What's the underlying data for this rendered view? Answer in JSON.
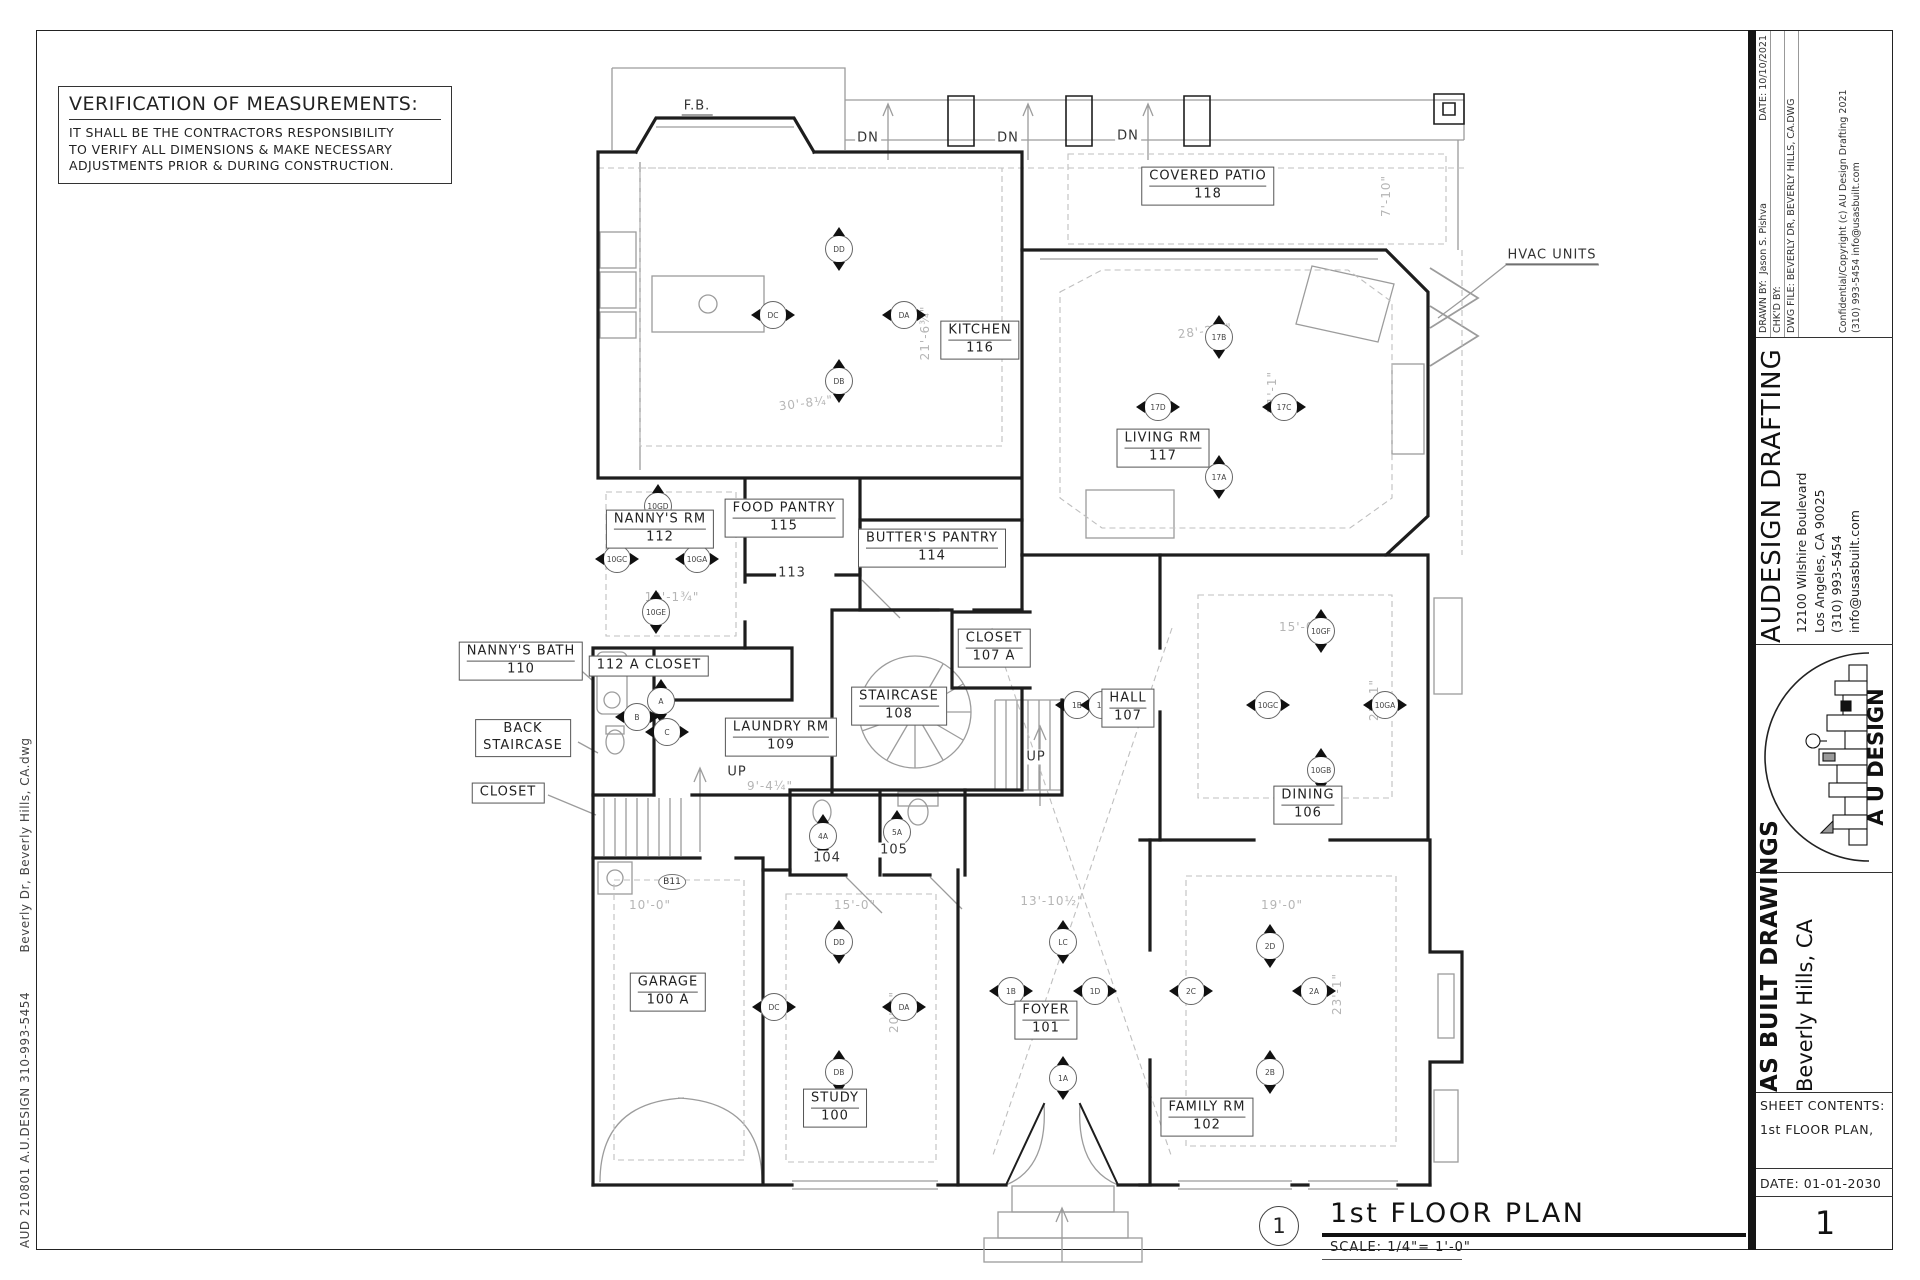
{
  "sheet": {
    "verification": {
      "title": "VERIFICATION OF MEASUREMENTS:",
      "lines": [
        "IT SHALL BE THE CONTRACTORS RESPONSIBILITY",
        "TO VERIFY ALL DIMENSIONS & MAKE NECESSARY",
        "ADJUSTMENTS PRIOR & DURING CONSTRUCTION."
      ]
    },
    "margin_text_top": "Beverly Dr, Beverly Hills, CA.dwg",
    "margin_text_bottom": "AUD 210801    A.U.DESIGN 310-993-5454",
    "plan_title": {
      "detail_number": "1",
      "title": "1st FLOOR PLAN",
      "scale": "SCALE: 1/4\"= 1'-0\""
    }
  },
  "title_block": {
    "drawn_by_label": "DRAWN BY:",
    "drawn_by": "Jason S. Pishva",
    "date_label": "DATE:",
    "date": "10/10/2021",
    "chkd_by_label": "CHK'D BY:",
    "dwg_file": "DWG FILE: BEVERLY DR, BEVERLY HILLS, CA.DWG",
    "copyright": "Confidential/Copyright (c) AU Design Drafting   2021",
    "copyright_contact": "(310) 993-5454    info@usasbuilt.com",
    "company": "AUDESIGN DRAFTING",
    "address_line1": "12100 Wilshire Boulevard",
    "address_line2": "Los Angeles, CA 90025",
    "phone": "(310) 993-5454",
    "email": "info@usasbuilt.com",
    "logo_text": "A U DESIGN",
    "project_title": "AS BUILT DRAWINGS",
    "project_location": "Beverly Hills, CA",
    "sheet_contents_label": "SHEET CONTENTS:",
    "sheet_contents_value": "1st FLOOR PLAN,",
    "date_row": "DATE: 01-01-2030",
    "sheet_number": "1"
  },
  "plan": {
    "rooms": [
      {
        "lines": [
          "KITCHEN",
          "116"
        ],
        "x": 980,
        "y": 340,
        "divider": true
      },
      {
        "lines": [
          "COVERED PATIO",
          "118"
        ],
        "x": 1208,
        "y": 186,
        "divider": true
      },
      {
        "lines": [
          "LIVING RM",
          "117"
        ],
        "x": 1163,
        "y": 448,
        "divider": true
      },
      {
        "lines": [
          "NANNY'S RM",
          "112"
        ],
        "x": 660,
        "y": 529,
        "divider": true
      },
      {
        "lines": [
          "FOOD PANTRY",
          "115"
        ],
        "x": 784,
        "y": 518,
        "divider": true
      },
      {
        "lines": [
          "BUTTER'S PANTRY",
          "114"
        ],
        "x": 932,
        "y": 548,
        "divider": true
      },
      {
        "lines": [
          "CLOSET",
          "107 A"
        ],
        "x": 994,
        "y": 648,
        "divider": true
      },
      {
        "lines": [
          "STAIRCASE",
          "108"
        ],
        "x": 899,
        "y": 706,
        "divider": true
      },
      {
        "lines": [
          "HALL",
          "107"
        ],
        "x": 1128,
        "y": 708,
        "divider": true
      },
      {
        "lines": [
          "NANNY'S BATH",
          "110"
        ],
        "x": 521,
        "y": 661,
        "divider": true
      },
      {
        "lines": [
          "112 A CLOSET"
        ],
        "x": 649,
        "y": 666,
        "divider": false
      },
      {
        "lines": [
          "BACK",
          "STAIRCASE"
        ],
        "x": 523,
        "y": 738,
        "divider": false
      },
      {
        "lines": [
          "LAUNDRY RM",
          "109"
        ],
        "x": 781,
        "y": 737,
        "divider": true
      },
      {
        "lines": [
          "CLOSET"
        ],
        "x": 508,
        "y": 793,
        "divider": false
      },
      {
        "lines": [
          "DINING",
          "106"
        ],
        "x": 1308,
        "y": 805,
        "divider": true
      },
      {
        "lines": [
          "GARAGE",
          "100 A"
        ],
        "x": 668,
        "y": 992,
        "divider": true
      },
      {
        "lines": [
          "STUDY",
          "100"
        ],
        "x": 835,
        "y": 1108,
        "divider": true
      },
      {
        "lines": [
          "FOYER",
          "101"
        ],
        "x": 1046,
        "y": 1020,
        "divider": true
      },
      {
        "lines": [
          "FAMILY RM",
          "102"
        ],
        "x": 1207,
        "y": 1117,
        "divider": true
      }
    ],
    "labels": [
      {
        "text": "F.B.",
        "x": 697,
        "y": 107,
        "style": "underline"
      },
      {
        "text": "DN",
        "x": 868,
        "y": 138,
        "style": "plain"
      },
      {
        "text": "DN",
        "x": 1008,
        "y": 138,
        "style": "plain"
      },
      {
        "text": "DN",
        "x": 1128,
        "y": 136,
        "style": "plain"
      },
      {
        "text": "HVAC UNITS",
        "x": 1552,
        "y": 256,
        "style": "underline"
      },
      {
        "text": "113",
        "x": 792,
        "y": 573,
        "style": "plain"
      },
      {
        "text": "UP",
        "x": 737,
        "y": 772,
        "style": "plain"
      },
      {
        "text": "UP",
        "x": 1036,
        "y": 757,
        "style": "plain"
      },
      {
        "text": "104",
        "x": 827,
        "y": 858,
        "style": "plain"
      },
      {
        "text": "105",
        "x": 894,
        "y": 850,
        "style": "plain"
      },
      {
        "text": "B11",
        "x": 672,
        "y": 882,
        "style": "oval"
      }
    ],
    "dimensions": [
      {
        "text": "21'-6¾\"",
        "x": 925,
        "y": 333,
        "rot": -90
      },
      {
        "text": "30'-8¼\"",
        "x": 806,
        "y": 403,
        "rot": -7
      },
      {
        "text": "28'-2½\"",
        "x": 1205,
        "y": 331,
        "rot": -7
      },
      {
        "text": "21'-1\"",
        "x": 1272,
        "y": 392,
        "rot": -90
      },
      {
        "text": "7'-10\"",
        "x": 1386,
        "y": 196,
        "rot": -90
      },
      {
        "text": "12'-1¾\"",
        "x": 672,
        "y": 597,
        "rot": 0
      },
      {
        "text": "15'-0\"",
        "x": 1300,
        "y": 627,
        "rot": 0
      },
      {
        "text": "21'-1\"",
        "x": 1374,
        "y": 700,
        "rot": -90
      },
      {
        "text": "9'-4¼\"",
        "x": 770,
        "y": 786,
        "rot": 0
      },
      {
        "text": "10'-0\"",
        "x": 650,
        "y": 905,
        "rot": 0
      },
      {
        "text": "15'-0\"",
        "x": 855,
        "y": 905,
        "rot": 0
      },
      {
        "text": "13'-10½\"",
        "x": 1052,
        "y": 901,
        "rot": 0
      },
      {
        "text": "19'-0\"",
        "x": 1282,
        "y": 905,
        "rot": 0
      },
      {
        "text": "20'-0\"",
        "x": 894,
        "y": 1012,
        "rot": -90
      },
      {
        "text": "23'-1\"",
        "x": 1337,
        "y": 994,
        "rot": -90
      }
    ],
    "symbols": [
      {
        "label": "DD",
        "x": 838,
        "y": 248,
        "dir": "v"
      },
      {
        "label": "DC",
        "x": 772,
        "y": 314,
        "dir": "h"
      },
      {
        "label": "DA",
        "x": 903,
        "y": 314,
        "dir": "h"
      },
      {
        "label": "DB",
        "x": 838,
        "y": 380,
        "dir": "v"
      },
      {
        "label": "10GD",
        "x": 657,
        "y": 505,
        "dir": "v"
      },
      {
        "label": "10GC",
        "x": 616,
        "y": 558,
        "dir": "h"
      },
      {
        "label": "10GA",
        "x": 696,
        "y": 558,
        "dir": "h"
      },
      {
        "label": "10GE",
        "x": 655,
        "y": 611,
        "dir": "v"
      },
      {
        "label": "17B",
        "x": 1218,
        "y": 336,
        "dir": "v"
      },
      {
        "label": "17D",
        "x": 1157,
        "y": 406,
        "dir": "h"
      },
      {
        "label": "17C",
        "x": 1283,
        "y": 406,
        "dir": "h"
      },
      {
        "label": "17A",
        "x": 1218,
        "y": 476,
        "dir": "v"
      },
      {
        "label": "1B",
        "x": 1076,
        "y": 704,
        "dir": "h"
      },
      {
        "label": "1D",
        "x": 1101,
        "y": 704,
        "dir": "h"
      },
      {
        "label": "10GF",
        "x": 1320,
        "y": 630,
        "dir": "v"
      },
      {
        "label": "10GC",
        "x": 1267,
        "y": 704,
        "dir": "h"
      },
      {
        "label": "10GA",
        "x": 1384,
        "y": 704,
        "dir": "h"
      },
      {
        "label": "10GB",
        "x": 1320,
        "y": 769,
        "dir": "v"
      },
      {
        "label": "DD",
        "x": 838,
        "y": 941,
        "dir": "v"
      },
      {
        "label": "DC",
        "x": 773,
        "y": 1006,
        "dir": "h"
      },
      {
        "label": "DA",
        "x": 903,
        "y": 1006,
        "dir": "h"
      },
      {
        "label": "DB",
        "x": 838,
        "y": 1071,
        "dir": "v"
      },
      {
        "label": "LC",
        "x": 1062,
        "y": 941,
        "dir": "v"
      },
      {
        "label": "1B",
        "x": 1010,
        "y": 990,
        "dir": "h"
      },
      {
        "label": "1D",
        "x": 1094,
        "y": 990,
        "dir": "h"
      },
      {
        "label": "1A",
        "x": 1062,
        "y": 1077,
        "dir": "v"
      },
      {
        "label": "2D",
        "x": 1269,
        "y": 945,
        "dir": "v"
      },
      {
        "label": "2C",
        "x": 1190,
        "y": 990,
        "dir": "h"
      },
      {
        "label": "2A",
        "x": 1313,
        "y": 990,
        "dir": "h"
      },
      {
        "label": "2B",
        "x": 1269,
        "y": 1071,
        "dir": "v"
      },
      {
        "label": "4A",
        "x": 822,
        "y": 835,
        "dir": "v"
      },
      {
        "label": "5A",
        "x": 896,
        "y": 831,
        "dir": "v"
      },
      {
        "label": "A",
        "x": 660,
        "y": 700,
        "dir": "v"
      },
      {
        "label": "B",
        "x": 636,
        "y": 716,
        "dir": "h"
      },
      {
        "label": "C",
        "x": 666,
        "y": 731,
        "dir": "h"
      }
    ]
  }
}
